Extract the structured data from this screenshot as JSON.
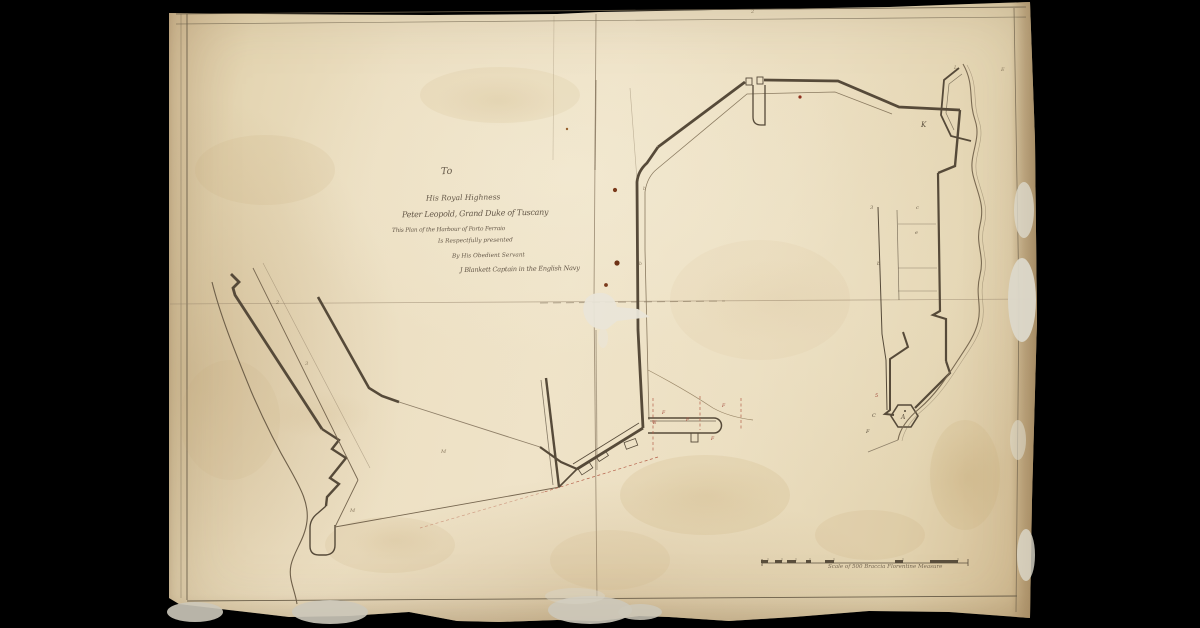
{
  "artifact": {
    "kind_label": "Manuscript harbour plan on aged paper"
  },
  "dedication": {
    "lines": [
      {
        "text": "To"
      },
      {
        "text": "His Royal Highness"
      },
      {
        "text": "Peter Leopold, Grand Duke of Tuscany"
      },
      {
        "text": "This Plan of the Harbour of Porto Ferraio"
      },
      {
        "text": "Is Respectfully presented"
      },
      {
        "text": "By His Obedient Servant"
      },
      {
        "text": "J Blankett Captain in the English Navy"
      }
    ]
  },
  "scale_bar": {
    "caption": "Scale of 500 Braccia Florentine Measure"
  },
  "map_labels": [
    {
      "text": "K"
    },
    {
      "text": "A"
    },
    {
      "text": "3"
    },
    {
      "text": "c"
    },
    {
      "text": "e"
    },
    {
      "text": "b"
    },
    {
      "text": "5"
    },
    {
      "text": "C"
    },
    {
      "text": "F"
    },
    {
      "text": "E"
    },
    {
      "text": "F"
    },
    {
      "text": "F"
    },
    {
      "text": "F"
    },
    {
      "text": "F"
    },
    {
      "text": "M"
    },
    {
      "text": "M"
    },
    {
      "text": "2"
    },
    {
      "text": "3"
    },
    {
      "text": "L"
    },
    {
      "text": "E"
    },
    {
      "text": "b"
    },
    {
      "text": "b"
    },
    {
      "text": "2"
    }
  ],
  "colors": {
    "background": "#000000",
    "paper": "#ece0c6",
    "paper_edge": "#d2bc94",
    "ink": "#564a39",
    "ink_light": "#8a7a60",
    "red_ink": "#b5604a",
    "red_letter": "#9e4436"
  }
}
